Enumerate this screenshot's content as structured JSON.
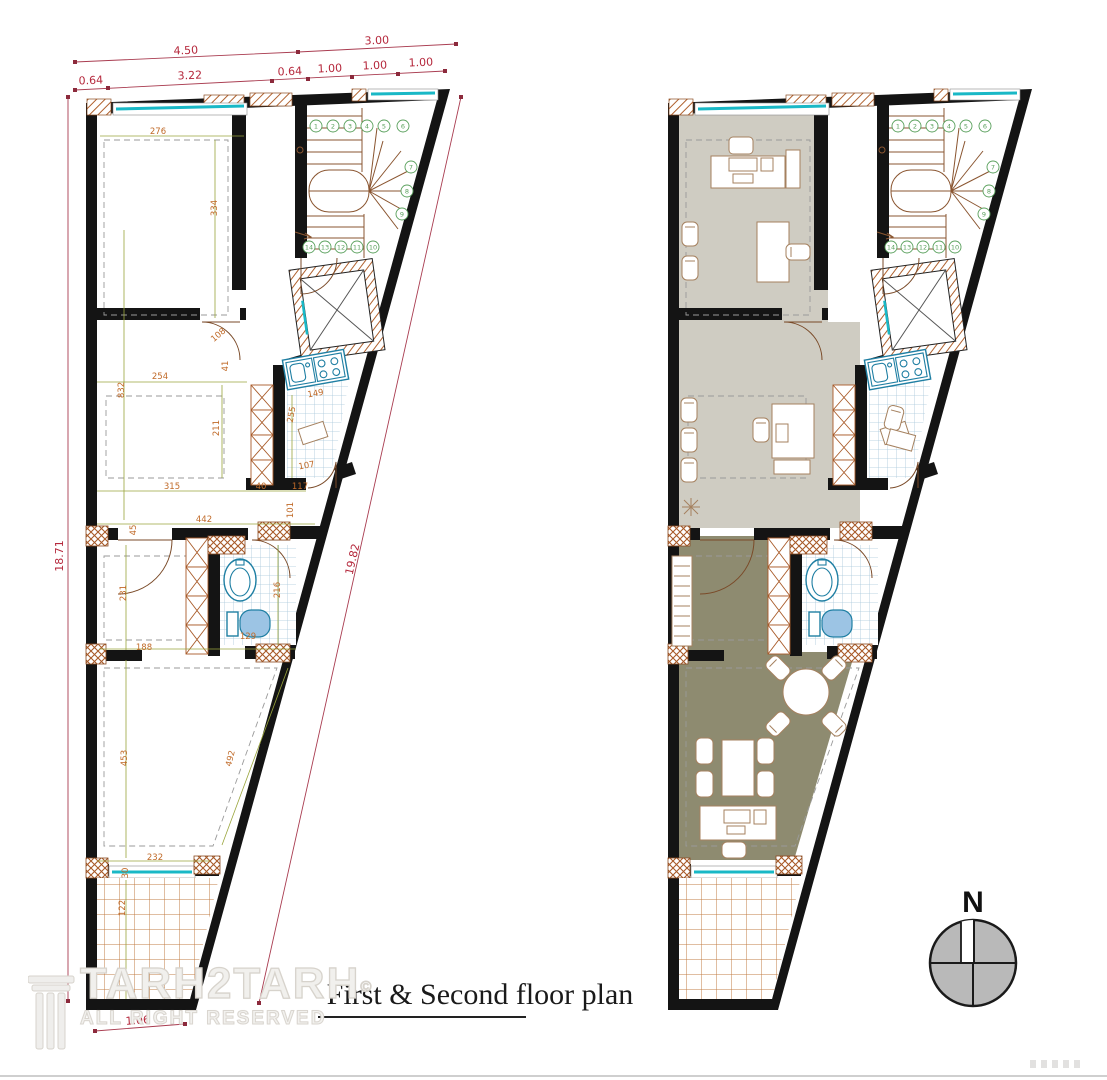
{
  "title": "First & Second floor plan",
  "watermark": {
    "name": "TARH2TARH",
    "copyright_symbol": "©",
    "subtitle": "ALL RIGHT RESERVED"
  },
  "compass": {
    "north_label": "N"
  },
  "dimensions": {
    "top_row_1": [
      "4.50",
      "3.00"
    ],
    "top_row_2": [
      "0.64",
      "3.22",
      "0.64",
      "1.00",
      "1.00",
      "1.00"
    ],
    "left_side": "18.71",
    "diagonal": "19.82",
    "bottom_tip": "1.06",
    "interior": {
      "room1_width": "276",
      "room1_height": "334",
      "rooms_left_height": "832",
      "room2_width": "254",
      "room2_height": "211",
      "room2_door": "108",
      "wall_offset": "41",
      "kitchen_width": "149",
      "kitchen_height": "255",
      "kitchen_door": "107",
      "room2_bottom": "315",
      "gap_a": "40",
      "gap_b": "117",
      "gap_c": "101",
      "hall_width": "442",
      "door_jamb": "45",
      "room3_height": "231",
      "room3_width": "188",
      "bath_height": "216",
      "bath_width": "129",
      "room4_height": "453",
      "room4_slope": "492",
      "room4_width": "232",
      "window_offset": "30",
      "balcony_depth": "122"
    }
  },
  "stairs": {
    "top_run": [
      "1",
      "2",
      "3",
      "4",
      "5",
      "6"
    ],
    "turn": [
      "7",
      "8",
      "9"
    ],
    "bottom_run": [
      "14",
      "13",
      "12",
      "11",
      "10"
    ]
  }
}
